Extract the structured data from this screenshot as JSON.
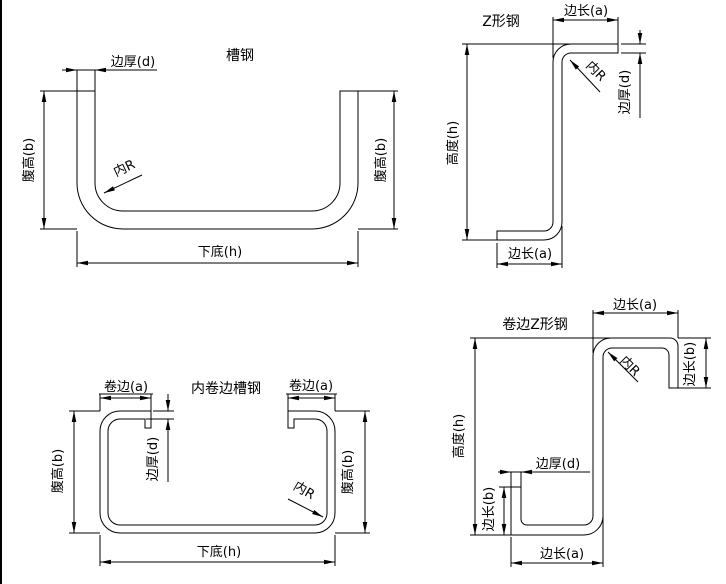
{
  "drawing": {
    "channel": {
      "title": "槽钢",
      "thickness": "边厚(d)",
      "web_left": "腹高(b)",
      "web_right": "腹高(b)",
      "radius": "内R",
      "bottom": "下底(h)"
    },
    "z_section": {
      "title": "Z形钢",
      "flange_top": "边长(a)",
      "thickness": "边厚(d)",
      "radius": "内R",
      "height": "高度(h)",
      "flange_bottom": "边长(a)"
    },
    "lipped_channel": {
      "title": "内卷边槽钢",
      "lip_left": "卷边(a)",
      "lip_right": "卷边(a)",
      "thickness": "边厚(d)",
      "web_left": "腹高(b)",
      "web_right": "腹高(b)",
      "radius": "内R",
      "bottom": "下底(h)"
    },
    "lipped_z": {
      "title": "卷边Z形钢",
      "flange_top": "边长(a)",
      "lip_right": "边长(b)",
      "radius": "内R",
      "height": "高度(h)",
      "thickness": "边厚(d)",
      "lip_left": "边长(b)",
      "flange_bottom": "边长(a)"
    },
    "colors": {
      "line": "#000000",
      "background": "#ffffff"
    }
  }
}
